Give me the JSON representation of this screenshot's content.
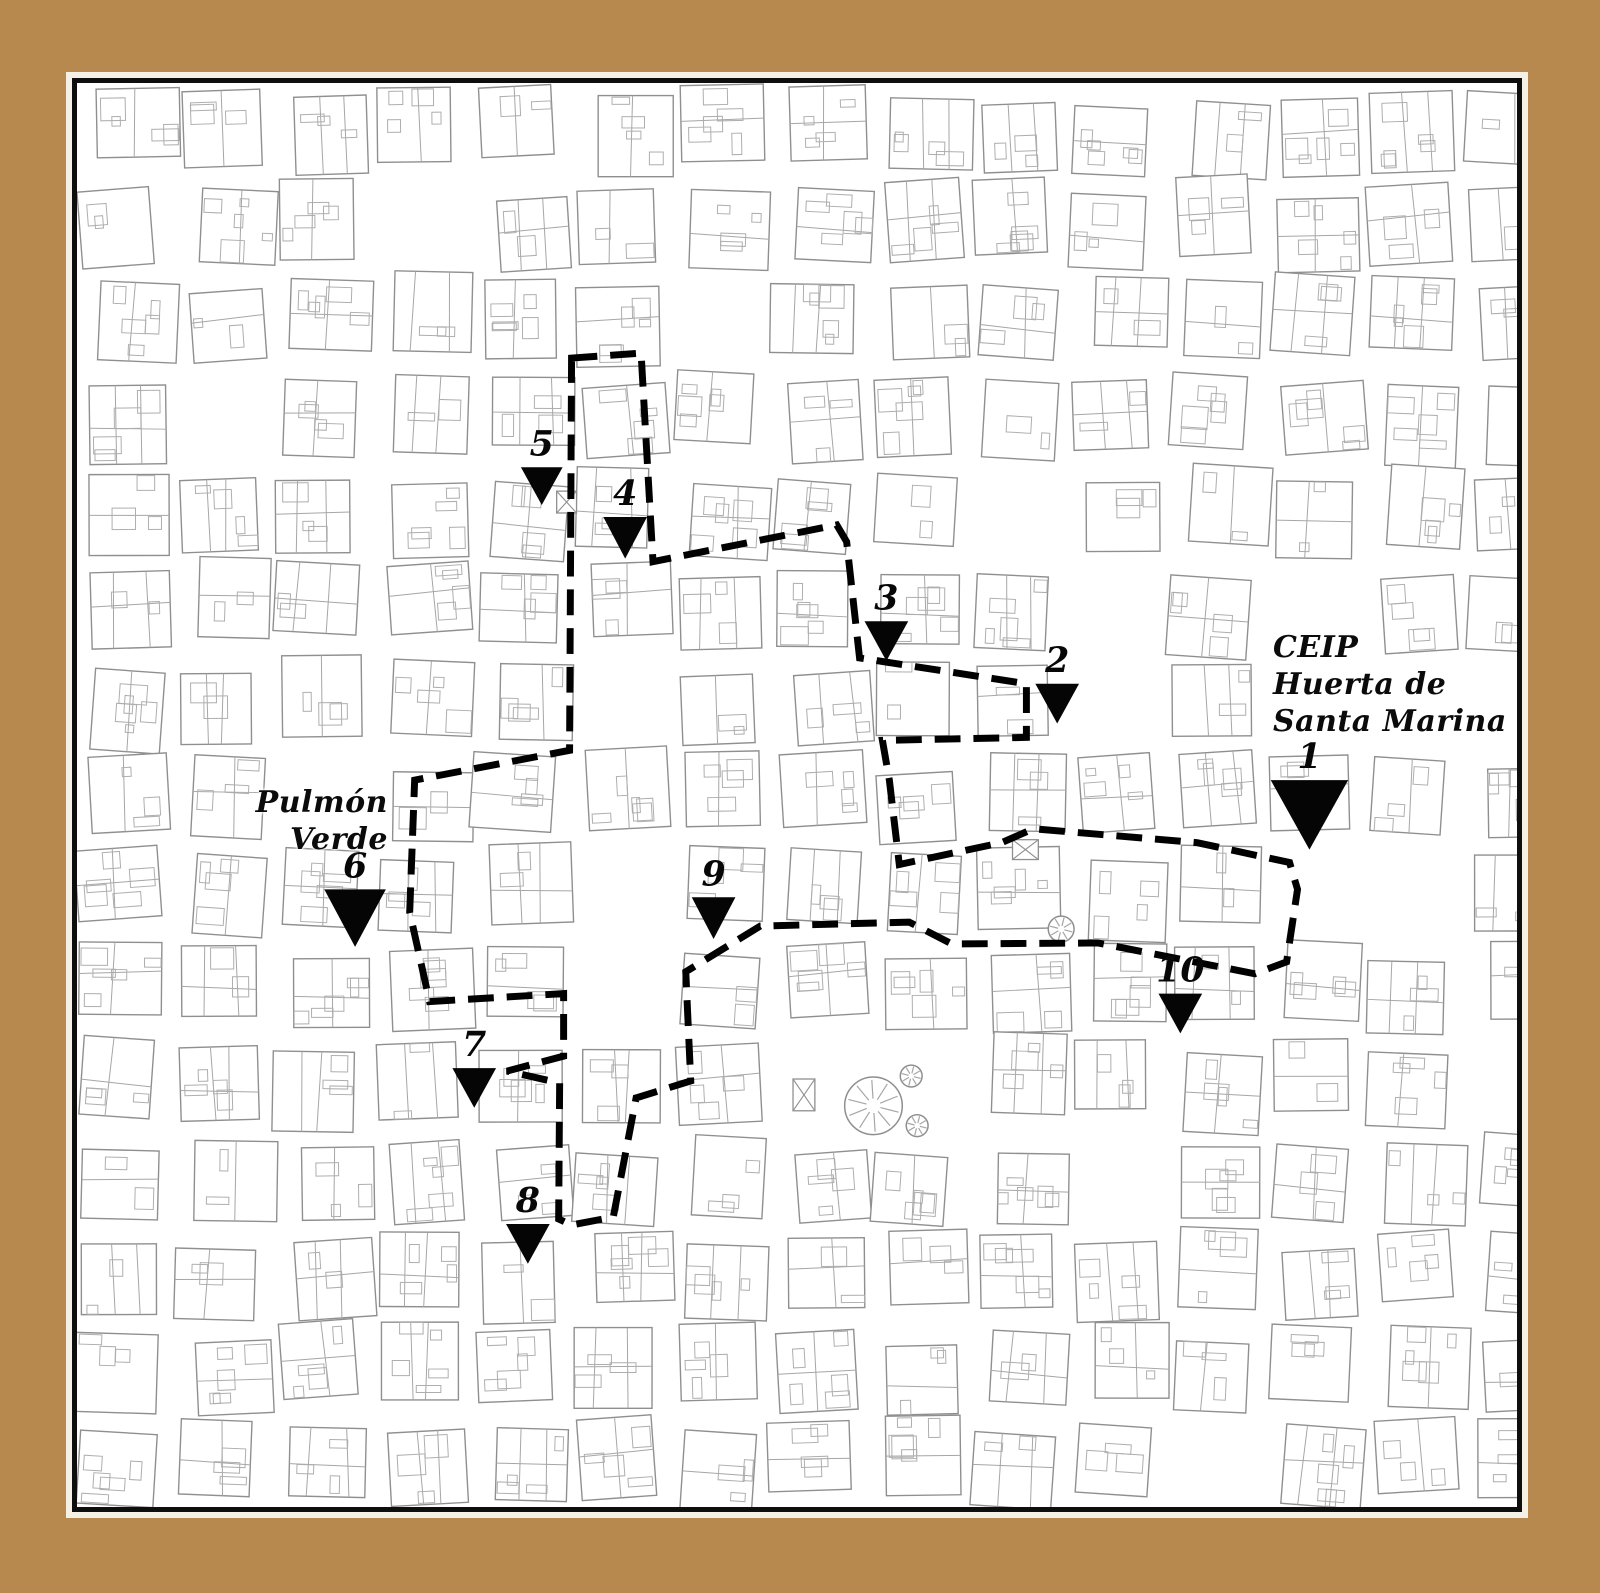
{
  "page": {
    "description_label": "Street map with dashed walking route and numbered stops"
  },
  "colors": {
    "mat_frame": "#b7894e",
    "map_background": "#ffffff",
    "frame_border": "#0e0e0e",
    "building_outline": "#8f8f8f",
    "parcel_outline": "#a6a6a6",
    "detail_outline": "#aeaeae",
    "route": "#000000",
    "marker": "#050505",
    "text": "#0b0b0b"
  },
  "map": {
    "left": 72,
    "top": 78,
    "width": 1450,
    "height": 1434
  },
  "labels": {
    "school": {
      "line1": "CEIP",
      "line2": "Huerta de",
      "line3": "Santa Marina"
    },
    "park": {
      "line1": "Pulmón",
      "line2": "Verde"
    }
  },
  "markers": [
    {
      "number": "1",
      "x": 1313,
      "y": 780,
      "w": 78,
      "h": 70
    },
    {
      "number": "2",
      "x": 1059,
      "y": 683,
      "w": 44,
      "h": 40
    },
    {
      "number": "3",
      "x": 887,
      "y": 620,
      "w": 44,
      "h": 40
    },
    {
      "number": "4",
      "x": 624,
      "y": 515,
      "w": 44,
      "h": 42
    },
    {
      "number": "5",
      "x": 540,
      "y": 465,
      "w": 42,
      "h": 38
    },
    {
      "number": "6",
      "x": 352,
      "y": 890,
      "w": 62,
      "h": 58
    },
    {
      "number": "7",
      "x": 472,
      "y": 1070,
      "w": 44,
      "h": 40
    },
    {
      "number": "8",
      "x": 526,
      "y": 1227,
      "w": 44,
      "h": 40
    },
    {
      "number": "9",
      "x": 713,
      "y": 898,
      "w": 44,
      "h": 42
    },
    {
      "number": "10",
      "x": 1183,
      "y": 995,
      "w": 44,
      "h": 40
    }
  ],
  "route": {
    "style": "dashed",
    "stroke_width": 7,
    "dash": [
      26,
      13
    ],
    "closed": true,
    "points": [
      [
        570,
        355
      ],
      [
        640,
        350
      ],
      [
        652,
        560
      ],
      [
        837,
        523
      ],
      [
        847,
        540
      ],
      [
        860,
        657
      ],
      [
        1028,
        683
      ],
      [
        1028,
        737
      ],
      [
        883,
        740
      ],
      [
        890,
        780
      ],
      [
        900,
        865
      ],
      [
        1003,
        843
      ],
      [
        1035,
        829
      ],
      [
        1200,
        843
      ],
      [
        1293,
        863
      ],
      [
        1301,
        890
      ],
      [
        1290,
        963
      ],
      [
        1258,
        975
      ],
      [
        1100,
        944
      ],
      [
        953,
        945
      ],
      [
        910,
        923
      ],
      [
        760,
        927
      ],
      [
        685,
        973
      ],
      [
        690,
        1083
      ],
      [
        635,
        1100
      ],
      [
        612,
        1220
      ],
      [
        570,
        1228
      ],
      [
        557,
        1222
      ],
      [
        558,
        1085
      ],
      [
        505,
        1073
      ],
      [
        562,
        1058
      ],
      [
        562,
        995
      ],
      [
        427,
        1003
      ],
      [
        407,
        913
      ],
      [
        412,
        780
      ],
      [
        568,
        750
      ]
    ]
  },
  "symbols": [
    {
      "type": "rosette",
      "x": 874,
      "y": 1108,
      "r": 29
    },
    {
      "type": "rosette",
      "x": 912,
      "y": 1078,
      "r": 11
    },
    {
      "type": "rosette",
      "x": 918,
      "y": 1128,
      "r": 11
    },
    {
      "type": "rosette",
      "x": 1063,
      "y": 930,
      "r": 13
    },
    {
      "type": "crossed-box",
      "x": 1027,
      "y": 850,
      "w": 26,
      "h": 20
    },
    {
      "type": "crossed-box",
      "x": 804,
      "y": 1097,
      "w": 22,
      "h": 32
    },
    {
      "type": "crossed-box",
      "x": 565,
      "y": 500,
      "w": 20,
      "h": 22
    }
  ],
  "open_zones": [
    [
      1340,
      700,
      95
    ],
    [
      1380,
      880,
      85
    ],
    [
      340,
      805,
      48
    ],
    [
      640,
      950,
      65
    ],
    [
      860,
      1085,
      70
    ],
    [
      690,
      300,
      52
    ]
  ]
}
